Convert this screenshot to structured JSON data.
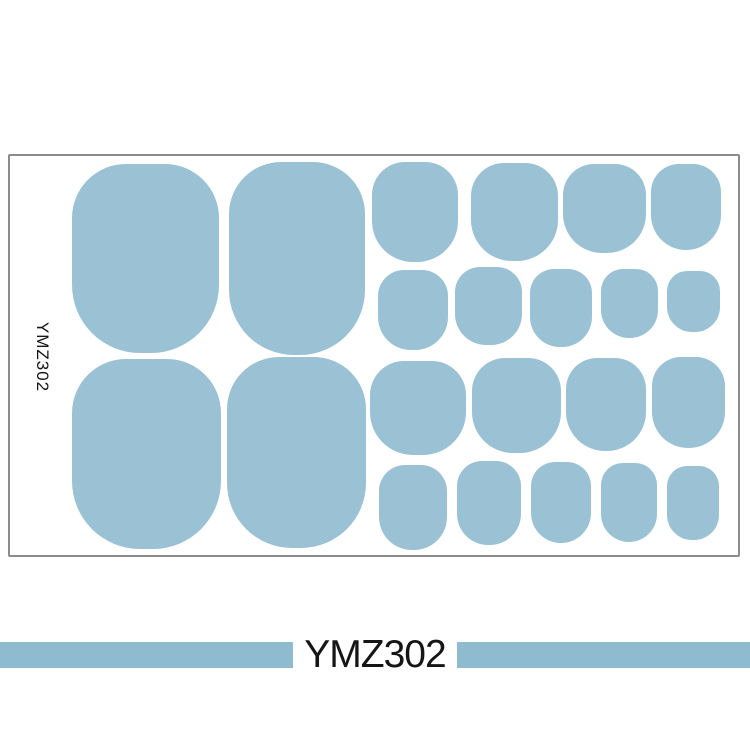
{
  "product": {
    "sheet_label_vertical": "YMZ302",
    "banner_label": "YMZ302"
  },
  "colors": {
    "nail_blue": "#9ac2d4",
    "banner_blue": "#8fbbd0",
    "sheet_border": "#8c8c8c",
    "label_text": "#151515"
  },
  "sheet": {
    "sticker_count": 22,
    "nails": [
      {
        "id": "g1-large-1",
        "x": 72,
        "y": 164,
        "w": 147,
        "h": 189,
        "r": 54
      },
      {
        "id": "g1-large-2",
        "x": 229,
        "y": 162,
        "w": 136,
        "h": 193,
        "r": 52
      },
      {
        "id": "g1-mid-1",
        "x": 372,
        "y": 162,
        "w": 86,
        "h": 100,
        "r": 33
      },
      {
        "id": "g1-mid-2",
        "x": 471,
        "y": 163,
        "w": 87,
        "h": 98,
        "r": 33
      },
      {
        "id": "g1-mid-3",
        "x": 563,
        "y": 164,
        "w": 83,
        "h": 89,
        "r": 31
      },
      {
        "id": "g1-mid-4",
        "x": 651,
        "y": 164,
        "w": 70,
        "h": 86,
        "r": 28
      },
      {
        "id": "g1-small-1",
        "x": 378,
        "y": 270,
        "w": 70,
        "h": 80,
        "r": 26
      },
      {
        "id": "g1-small-2",
        "x": 455,
        "y": 267,
        "w": 67,
        "h": 78,
        "r": 25
      },
      {
        "id": "g1-small-3",
        "x": 530,
        "y": 269,
        "w": 62,
        "h": 78,
        "r": 24
      },
      {
        "id": "g1-small-4",
        "x": 601,
        "y": 269,
        "w": 57,
        "h": 69,
        "r": 22
      },
      {
        "id": "g1-small-5",
        "x": 667,
        "y": 271,
        "w": 53,
        "h": 61,
        "r": 20
      },
      {
        "id": "g2-large-1",
        "x": 72,
        "y": 359,
        "w": 149,
        "h": 190,
        "r": 54
      },
      {
        "id": "g2-large-2",
        "x": 227,
        "y": 357,
        "w": 139,
        "h": 191,
        "r": 52
      },
      {
        "id": "g2-mid-1",
        "x": 370,
        "y": 361,
        "w": 96,
        "h": 94,
        "r": 34
      },
      {
        "id": "g2-mid-2",
        "x": 472,
        "y": 358,
        "w": 89,
        "h": 95,
        "r": 33
      },
      {
        "id": "g2-mid-3",
        "x": 566,
        "y": 358,
        "w": 80,
        "h": 93,
        "r": 31
      },
      {
        "id": "g2-mid-4",
        "x": 652,
        "y": 357,
        "w": 73,
        "h": 91,
        "r": 29
      },
      {
        "id": "g2-small-1",
        "x": 379,
        "y": 465,
        "w": 68,
        "h": 85,
        "r": 26
      },
      {
        "id": "g2-small-2",
        "x": 457,
        "y": 461,
        "w": 64,
        "h": 84,
        "r": 25
      },
      {
        "id": "g2-small-3",
        "x": 531,
        "y": 462,
        "w": 60,
        "h": 81,
        "r": 24
      },
      {
        "id": "g2-small-4",
        "x": 601,
        "y": 463,
        "w": 56,
        "h": 79,
        "r": 22
      },
      {
        "id": "g2-small-5",
        "x": 667,
        "y": 466,
        "w": 52,
        "h": 74,
        "r": 20
      }
    ]
  }
}
